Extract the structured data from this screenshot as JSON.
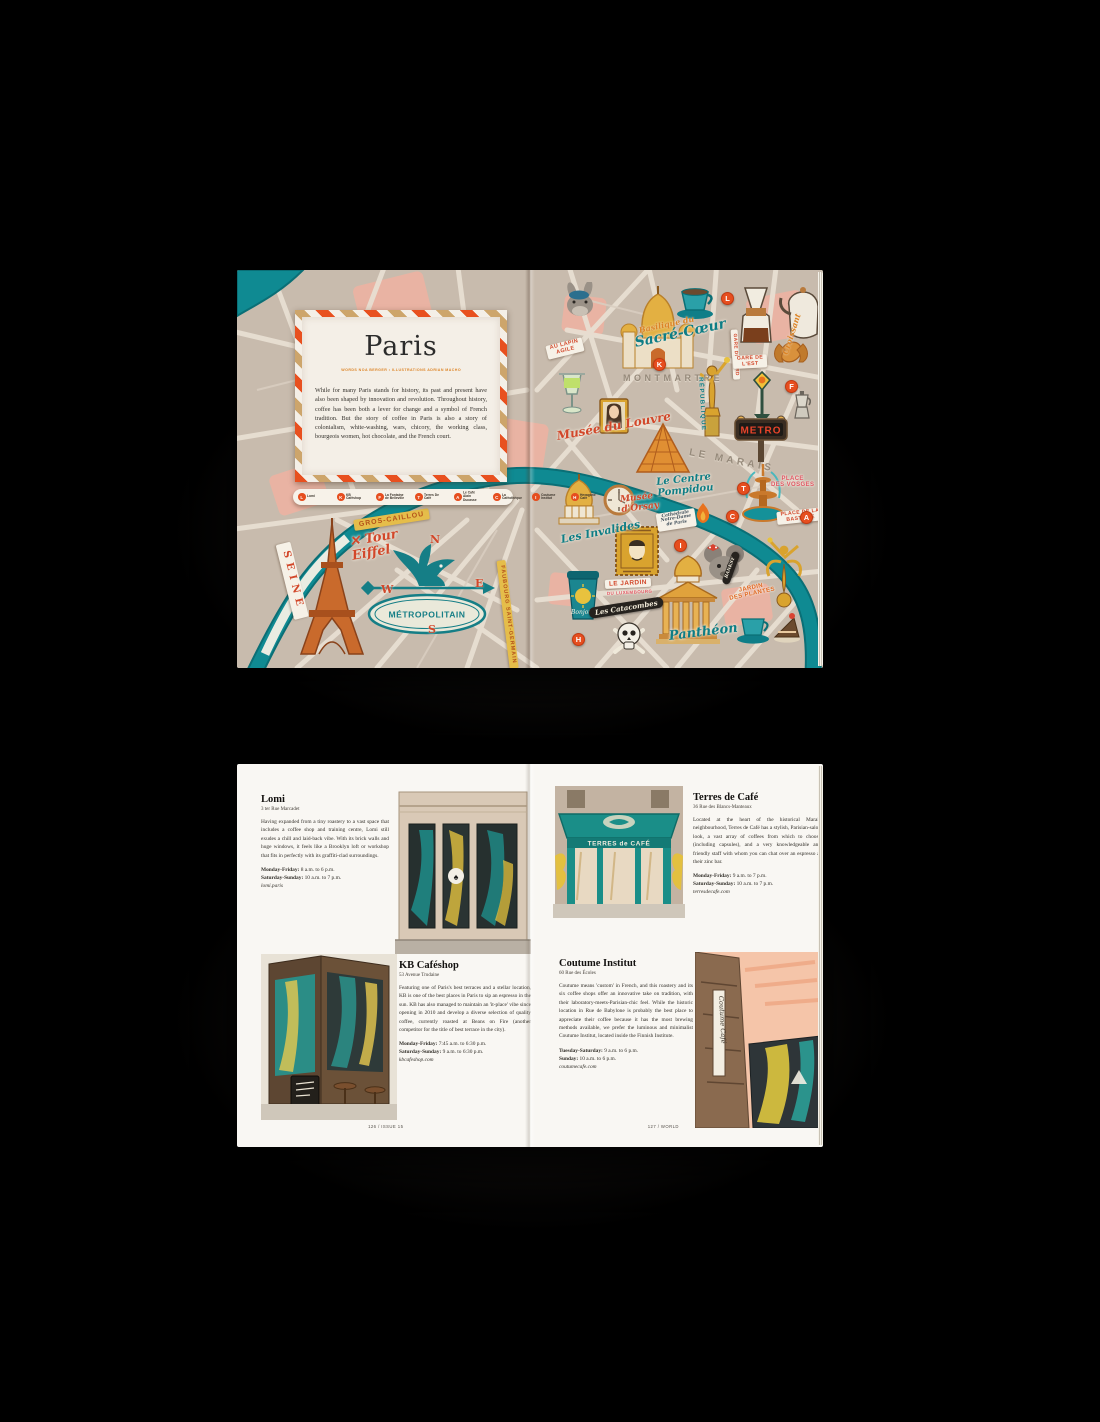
{
  "colors": {
    "background": "#000000",
    "map_base": "#c8bbad",
    "river": "#0f8a92",
    "accent": "#e64e1f",
    "gold": "#e0a43a",
    "teal": "#157e86",
    "pink": "#f2b2a0",
    "card": "#f4efe7",
    "page": "#f9f7f3"
  },
  "map_spread": {
    "title_card": {
      "title": "Paris",
      "byline": "WORDS NOA BERGER  •  ILLUSTRATIONS ADRIAN MACHO",
      "intro": "While for many Paris stands for history, its past and present have also been shaped by innovation and revolution. Throughout history, coffee has been both a lever for change and a symbol of French tradition. But the story of coffee in Paris is also a story of colonialism, white-washing, wars, chicory, the working class, bourgeois women, hot chocolate, and the French court."
    },
    "legend": {
      "items": [
        {
          "letter": "L",
          "label": "Lomi"
        },
        {
          "letter": "K",
          "label": "KB Caféshop"
        },
        {
          "letter": "F",
          "label": "La Fontaine de Belleville"
        },
        {
          "letter": "T",
          "label": "Terres De Café"
        },
        {
          "letter": "A",
          "label": "Le Café Alain Ducasse"
        },
        {
          "letter": "C",
          "label": "La Caféothèque"
        },
        {
          "letter": "I",
          "label": "Coutume Institut"
        },
        {
          "letter": "H",
          "label": "Hexagone Café"
        }
      ]
    },
    "signs": {
      "metropolitain": "MÉTROPOLITAIN",
      "metro": "METRO",
      "bonjour": "Bonjour"
    },
    "labels": [
      {
        "name": "seine-label",
        "lines": [
          "SEINE"
        ],
        "cls": "seine-band",
        "x": 46,
        "y": 266,
        "rot": 76
      },
      {
        "name": "gros-caillou-label",
        "lines": [
          "GROS-CAILLOU"
        ],
        "cls": "tag-yellow",
        "x": 117,
        "y": 250,
        "rot": -9
      },
      {
        "name": "tour-eiffel-label",
        "lines": [
          "✕ Tour",
          "Eiffel"
        ],
        "cls": "script-red",
        "x": 114,
        "y": 266,
        "rot": -10,
        "fs": 13
      },
      {
        "name": "compass-n",
        "lines": [
          "N"
        ],
        "cls": "compass",
        "x": 193,
        "y": 264,
        "rot": 0
      },
      {
        "name": "compass-e",
        "lines": [
          "E"
        ],
        "cls": "compass",
        "x": 238,
        "y": 308,
        "rot": 0
      },
      {
        "name": "compass-w",
        "lines": [
          "W"
        ],
        "cls": "compass",
        "x": 144,
        "y": 314,
        "rot": 0
      },
      {
        "name": "compass-s",
        "lines": [
          "S"
        ],
        "cls": "compass",
        "x": 191,
        "y": 354,
        "rot": 0
      },
      {
        "name": "faubourg-saint-germain-label",
        "lines": [
          "FAUBOURG SAINT-GERMAIN"
        ],
        "cls": "tag-yellow",
        "x": 264,
        "y": 286,
        "rot": 83,
        "fs": 5.5
      },
      {
        "name": "au-lapin-agile-label",
        "lines": [
          "AU LAPIN",
          "AGILE"
        ],
        "cls": "tag-white",
        "x": 310,
        "y": 76,
        "rot": -14
      },
      {
        "name": "basilique-script-label",
        "lines": [
          "Basilique du"
        ],
        "cls": "script-orange",
        "x": 402,
        "y": 56,
        "rot": -12,
        "fs": 8
      },
      {
        "name": "sacre-coeur-label",
        "lines": [
          "Sacré-Cœur"
        ],
        "cls": "script-teal",
        "x": 398,
        "y": 66,
        "rot": -12,
        "fs": 14
      },
      {
        "name": "montmartre-label",
        "lines": [
          "MONTMARTRE"
        ],
        "cls": "caps-grey",
        "x": 386,
        "y": 104,
        "rot": 0
      },
      {
        "name": "gare-du-nord-label",
        "lines": [
          "GARE DU NORD"
        ],
        "cls": "tag-white",
        "x": 497,
        "y": 56,
        "rot": 87,
        "fs": 4.8
      },
      {
        "name": "gare-de-lest-label",
        "lines": [
          "GARE DE",
          "L'EST"
        ],
        "cls": "tag-white",
        "x": 496,
        "y": 86,
        "rot": -3,
        "fs": 5.2
      },
      {
        "name": "croissant-label",
        "lines": [
          "Croissant"
        ],
        "cls": "script-orange",
        "x": 548,
        "y": 80,
        "rot": -72,
        "fs": 8
      },
      {
        "name": "republique-label",
        "lines": [
          "RÉPUBLIQUE"
        ],
        "cls": "caps-teal",
        "x": 463,
        "y": 104,
        "rot": 87
      },
      {
        "name": "le-marais-label",
        "lines": [
          "LE MARAIS"
        ],
        "cls": "caps-grey",
        "x": 452,
        "y": 178,
        "rot": 11,
        "fs": 10
      },
      {
        "name": "musee-du-louvre-label",
        "lines": [
          "Musée du Louvre"
        ],
        "cls": "script-red",
        "x": 320,
        "y": 160,
        "rot": -10,
        "fs": 12
      },
      {
        "name": "centre-pompidou-label",
        "lines": [
          "Le Centre",
          "Pompidou"
        ],
        "cls": "script-teal",
        "x": 420,
        "y": 208,
        "rot": -6,
        "fs": 10
      },
      {
        "name": "place-des-vosges-label",
        "lines": [
          "PLACE",
          "DES VOSGES"
        ],
        "cls": "caps-pink",
        "x": 534,
        "y": 206,
        "rot": 0
      },
      {
        "name": "musee-dorsay-label",
        "lines": [
          "Musée",
          "d'Orsay"
        ],
        "cls": "script-red",
        "x": 384,
        "y": 226,
        "rot": -7,
        "fs": 9
      },
      {
        "name": "les-invalides-label",
        "lines": [
          "Les Invalides"
        ],
        "cls": "script-teal",
        "x": 324,
        "y": 264,
        "rot": -11,
        "fs": 11
      },
      {
        "name": "notre-dame-label",
        "lines": [
          "Cathédrale",
          "Notre-Dame",
          "de Paris"
        ],
        "cls": "tag-script",
        "x": 420,
        "y": 244,
        "rot": -9
      },
      {
        "name": "place-de-la-bastille-label",
        "lines": [
          "PLACE DE LA",
          "BASTILLE"
        ],
        "cls": "tag-white",
        "x": 540,
        "y": 242,
        "rot": -6,
        "fs": 5.2
      },
      {
        "name": "le-jardin-label",
        "lines": [
          "LE JARDIN"
        ],
        "cls": "tag-white",
        "x": 368,
        "y": 310,
        "rot": -3,
        "fs": 6.5
      },
      {
        "name": "du-luxembourg-label",
        "lines": [
          "DU LUXEMBOURG"
        ],
        "cls": "caps-pink",
        "x": 370,
        "y": 322,
        "rot": -3,
        "fs": 4.5
      },
      {
        "name": "les-catacombes-label",
        "lines": [
          "Les Catacombes"
        ],
        "cls": "tag-black",
        "x": 352,
        "y": 338,
        "rot": -9
      },
      {
        "name": "pantheon-label",
        "lines": [
          "Panthéon"
        ],
        "cls": "script-teal",
        "x": 432,
        "y": 360,
        "rot": -7,
        "fs": 13
      },
      {
        "name": "jardin-des-plantes-label",
        "lines": [
          "JARDIN",
          "DES PLANTES"
        ],
        "cls": "caps-orange",
        "x": 492,
        "y": 320,
        "rot": -12
      },
      {
        "name": "banksy-label",
        "lines": [
          "BANKSY"
        ],
        "cls": "tag-black",
        "x": 488,
        "y": 310,
        "rot": -70,
        "fs": 4.5
      }
    ],
    "markers": [
      {
        "letter": "L",
        "x": 484,
        "y": 22
      },
      {
        "letter": "K",
        "x": 416,
        "y": 88
      },
      {
        "letter": "F",
        "x": 548,
        "y": 110
      },
      {
        "letter": "T",
        "x": 500,
        "y": 212
      },
      {
        "letter": "C",
        "x": 489,
        "y": 240
      },
      {
        "letter": "A",
        "x": 563,
        "y": 241
      },
      {
        "letter": "I",
        "x": 437,
        "y": 269
      },
      {
        "letter": "H",
        "x": 335,
        "y": 363
      }
    ]
  },
  "guide_spread": {
    "signs": {
      "terres_awning": "TERRES de CAFÉ",
      "coutume_sign": "Coutume Café",
      "lomi_logo": "♠"
    },
    "footer_left": "126 / ISSUE 15",
    "footer_right": "127 / WORLD",
    "listings": [
      {
        "name": "Lomi",
        "address": "3 ter Rue Marcadet",
        "body": "Having expanded from a tiny roastery to a vast space that includes a coffee shop and training centre, Lomi still exudes a chill and laid-back vibe. With its brick walls and huge windows, it feels like a Brooklyn loft or workshop that fits in perfectly with its graffiti-clad surroundings.",
        "hours": [
          {
            "label": "Monday-Friday:",
            "value": "8 a.m. to 6 p.m."
          },
          {
            "label": "Saturday-Sunday:",
            "value": "10 a.m. to 7 p.m."
          }
        ],
        "url": "lomi.paris"
      },
      {
        "name": "KB Caféshop",
        "address": "53 Avenue Trudaine",
        "body": "Featuring one of Paris's best terraces and a stellar location, KB is one of the best places in Paris to sip an espresso in the sun. KB has also managed to maintain an 'it-place' vibe since opening in 2010 and develop a diverse selection of quality coffee, currently roasted at Beans on Fire (another competitor for the title of best terrace in the city).",
        "hours": [
          {
            "label": "Monday-Friday:",
            "value": "7:45 a.m. to 6:30 p.m."
          },
          {
            "label": "Saturday-Sunday:",
            "value": "9 a.m. to 6:30 p.m."
          }
        ],
        "url": "kbcafeshop.com"
      },
      {
        "name": "Terres de Café",
        "address": "36 Rue des Blancs-Manteaux",
        "body": "Located at the heart of the historical Marais neighbourhood, Terres de Café has a stylish, Parisian-salon look, a vast array of coffees from which to choose (including capsules), and a very knowledgeable and friendly staff with whom you can chat over an espresso at their zinc bar.",
        "hours": [
          {
            "label": "Monday-Friday:",
            "value": "9 a.m. to 7 p.m."
          },
          {
            "label": "Saturday-Sunday:",
            "value": "10 a.m. to 7 p.m."
          }
        ],
        "url": "terresdecafe.com"
      },
      {
        "name": "Coutume Institut",
        "address": "60 Rue des Écoles",
        "body": "Coutume means 'custom' in French, and this roastery and its six coffee shops offer an innovative take on tradition, with their laboratory-meets-Parisian-chic feel. While the historic location in Rue de Babylone is probably the best place to appreciate their coffee because it has the most brewing methods available, we prefer the luminous and minimalist Coutume Institut, located inside the Finnish Institute.",
        "hours": [
          {
            "label": "Tuesday-Saturday:",
            "value": "9 a.m. to 6 p.m."
          },
          {
            "label": "Sunday:",
            "value": "10 a.m. to 6 p.m."
          }
        ],
        "url": "coutumecafe.com"
      }
    ]
  }
}
